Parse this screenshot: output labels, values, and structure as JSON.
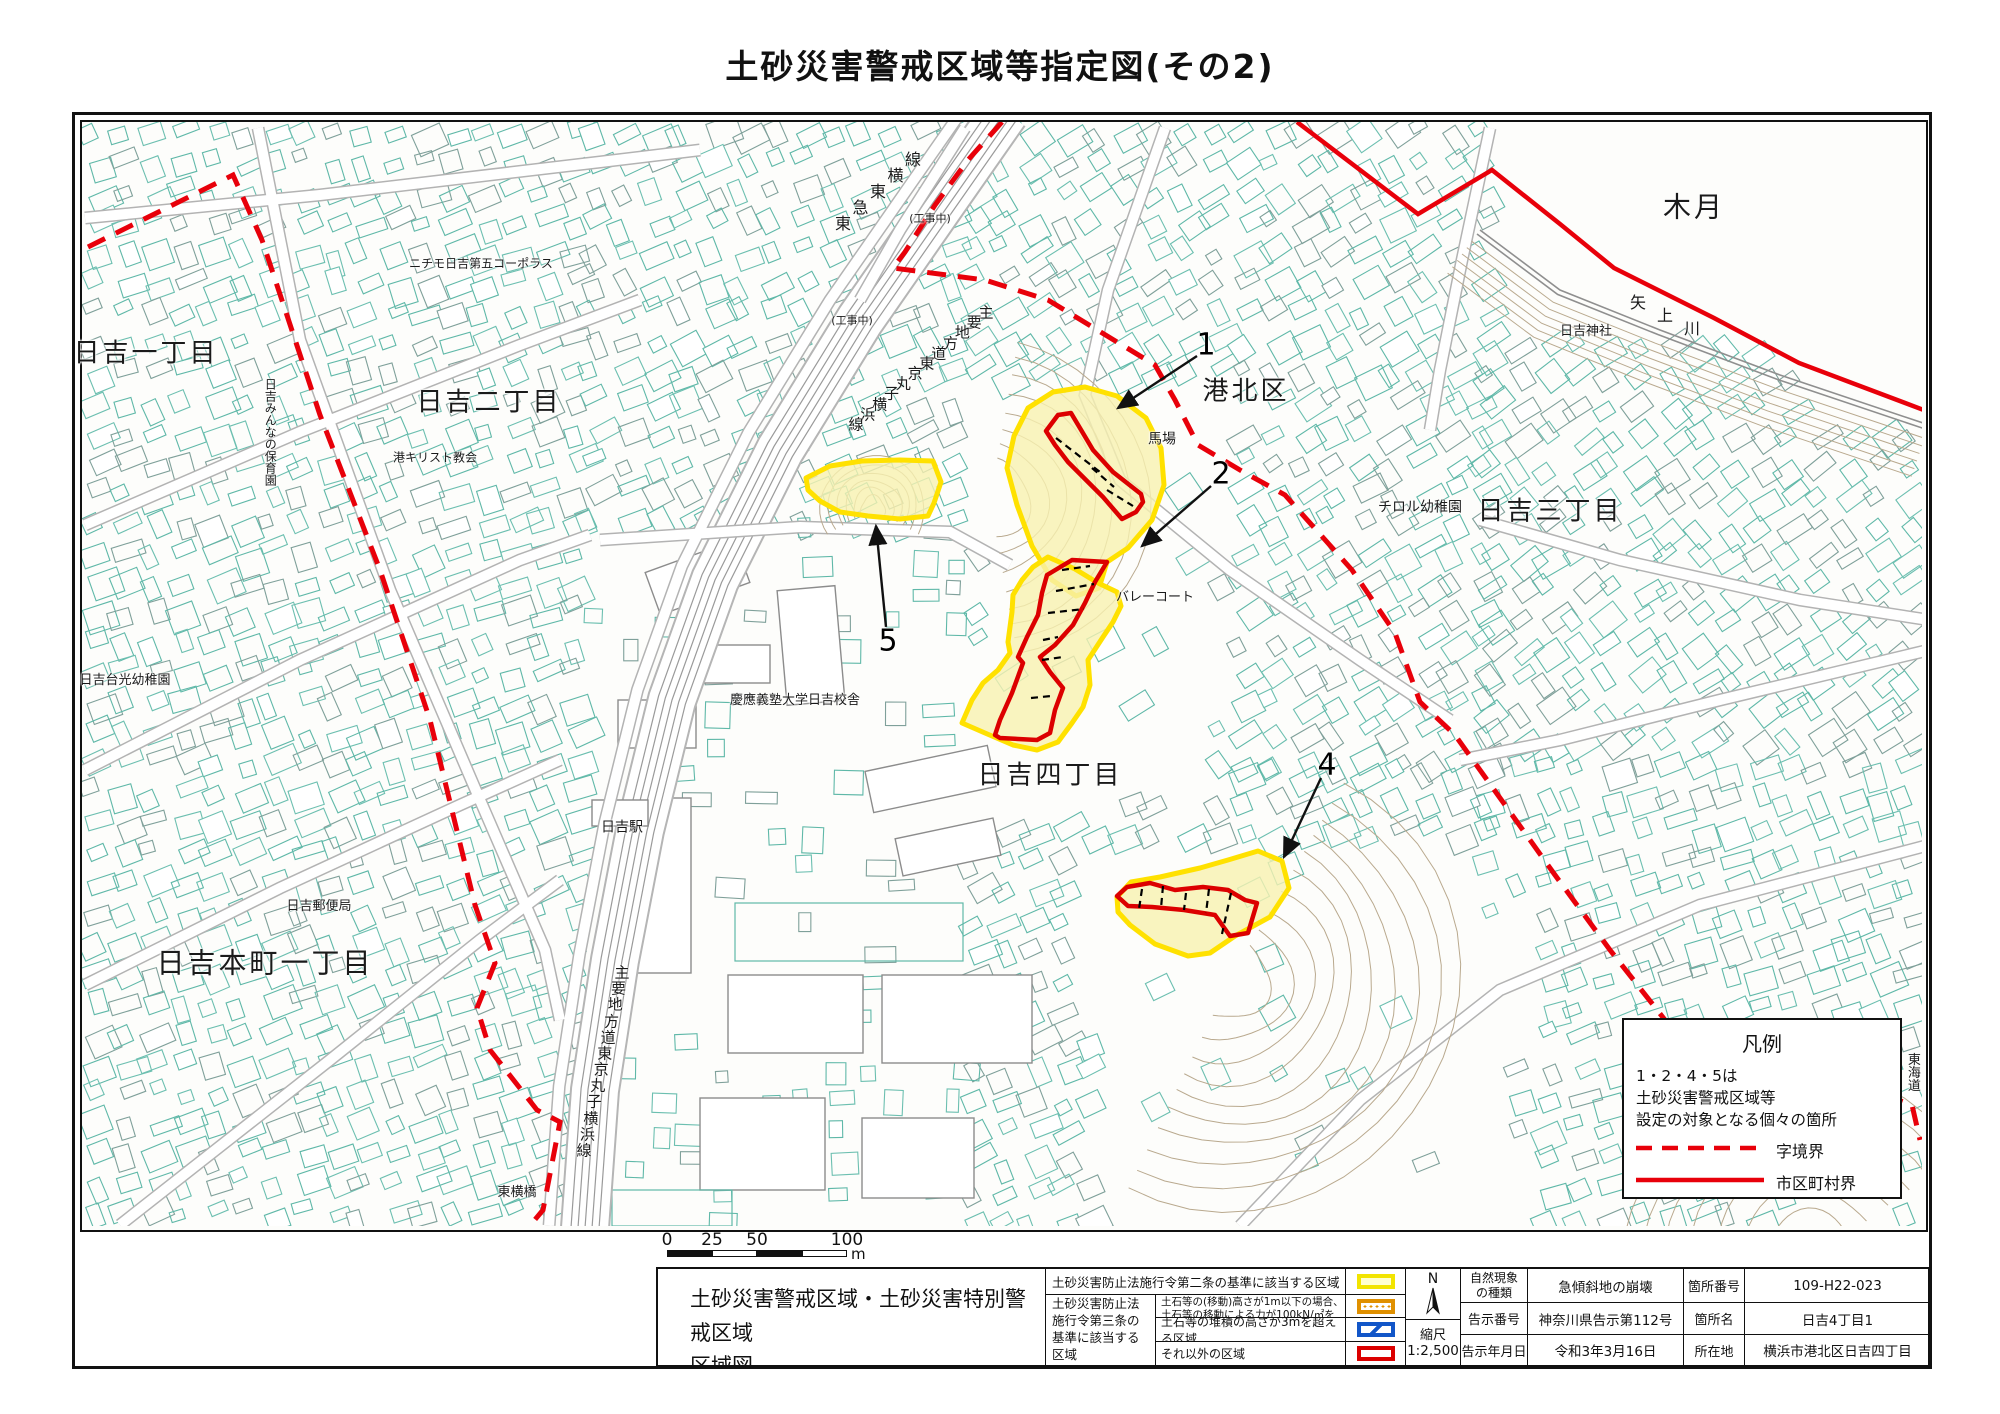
{
  "title": "土砂災害警戒区域等指定図(その2)",
  "map": {
    "labels": [
      {
        "t": "日吉一丁目",
        "x": 146,
        "y": 354,
        "s": 26
      },
      {
        "t": "日吉二丁目",
        "x": 489,
        "y": 403,
        "s": 26
      },
      {
        "t": "ニチモ日吉第五コーポラス",
        "x": 481,
        "y": 264,
        "s": 12
      },
      {
        "t": "日吉みんなの保育園",
        "x": 270,
        "y": 432,
        "s": 12,
        "v": 1
      },
      {
        "t": "港キリスト教会",
        "x": 435,
        "y": 458,
        "s": 12
      },
      {
        "t": "(工事中)",
        "x": 930,
        "y": 219,
        "s": 11
      },
      {
        "t": "(工事中)",
        "x": 852,
        "y": 321,
        "s": 11
      },
      {
        "t": "港北区",
        "x": 1246,
        "y": 392,
        "s": 26
      },
      {
        "t": "馬場",
        "x": 1162,
        "y": 440,
        "s": 14
      },
      {
        "t": "バレーコート",
        "x": 1155,
        "y": 598,
        "s": 13
      },
      {
        "t": "チロル幼稚園",
        "x": 1420,
        "y": 508,
        "s": 14
      },
      {
        "t": "日吉三丁目",
        "x": 1550,
        "y": 512,
        "s": 26
      },
      {
        "t": "日吉四丁目",
        "x": 1050,
        "y": 776,
        "s": 26
      },
      {
        "t": "慶應義塾大学日吉校舎",
        "x": 795,
        "y": 701,
        "s": 13
      },
      {
        "t": "日吉駅",
        "x": 622,
        "y": 828,
        "s": 14
      },
      {
        "t": "日吉台光幼稚園",
        "x": 125,
        "y": 681,
        "s": 13
      },
      {
        "t": "日吉郵便局",
        "x": 319,
        "y": 907,
        "s": 13
      },
      {
        "t": "日吉本町一丁目",
        "x": 265,
        "y": 963,
        "s": 28
      },
      {
        "t": "東横橋",
        "x": 517,
        "y": 1193,
        "s": 13
      },
      {
        "t": "木月",
        "x": 1694,
        "y": 207,
        "s": 28
      },
      {
        "t": "日吉神社",
        "x": 1586,
        "y": 332,
        "s": 13
      },
      {
        "t": "東海道",
        "x": 1912,
        "y": 1072,
        "s": 13,
        "v": 1
      }
    ],
    "path_labels": [
      {
        "t": "東急東横線",
        "x1": 843,
        "y1": 222,
        "x2": 913,
        "y2": 158,
        "s": 16
      },
      {
        "t": "主要地方道東京丸子横浜線",
        "x1": 986,
        "y1": 312,
        "x2": 856,
        "y2": 424,
        "s": 15
      },
      {
        "t": "主要地方道東京丸子横浜線",
        "x1": 622,
        "y1": 972,
        "x2": 584,
        "y2": 1150,
        "s": 15
      },
      {
        "t": "矢上川",
        "x1": 1638,
        "y1": 301,
        "x2": 1692,
        "y2": 327,
        "s": 16
      }
    ],
    "markers": [
      {
        "n": "1",
        "x": 1206,
        "y": 345,
        "ax": 1197,
        "ay": 356,
        "bx": 1118,
        "by": 408
      },
      {
        "n": "2",
        "x": 1221,
        "y": 474,
        "ax": 1211,
        "ay": 486,
        "bx": 1142,
        "by": 546
      },
      {
        "n": "4",
        "x": 1327,
        "y": 765,
        "ax": 1321,
        "ay": 778,
        "bx": 1284,
        "by": 857
      },
      {
        "n": "5",
        "x": 888,
        "y": 641,
        "ax": 886,
        "ay": 627,
        "bx": 876,
        "by": 526
      }
    ],
    "legend": {
      "title": "凡例",
      "line1": "1・2・4・5は",
      "line2": "土砂災害警戒区域等",
      "line3": "設定の対象となる個々の箇所",
      "dashed_label": "字境界",
      "solid_label": "市区町村界"
    }
  },
  "scalebar": {
    "t0": "0",
    "t1": "25",
    "t2": "50",
    "t3": "100",
    "unit": "m"
  },
  "titleblock": {
    "doc1": "土砂災害警戒区域・土砂災害特別警戒区域",
    "doc2": "区域図",
    "leg_row1": "土砂災害防止法施行令第二条の基準に該当する区域",
    "leg_group": "土砂災害防止法施行令第三条の基準に該当する区域",
    "leg_r2a": "土石等の(移動)高さが1m以下の場合、",
    "leg_r2b": "土石等の移動による力が100kN/㎡を超える区域",
    "leg_r3": "土石等の堆積の高さが3mを超える区域",
    "leg_r4": "それ以外の区域",
    "compass": "N",
    "scale_label": "縮尺",
    "scale_value": "1:2,500",
    "meta": {
      "r1l1": "自然現象の種類",
      "r1v1": "急傾斜地の崩壊",
      "r1l2": "箇所番号",
      "r1v2": "109-H22-023",
      "r2l1": "告示番号",
      "r2v1": "神奈川県告示第112号",
      "r2l2": "箇所名",
      "r2v2": "日吉4丁目1",
      "r3l1": "告示年月日",
      "r3v1": "令和3年3月16日",
      "r3l2": "所在地",
      "r3v2": "横浜市港北区日吉四丁目"
    }
  },
  "colors": {
    "boundary_red": "#e8000a",
    "zone_yellow": "#ffe100",
    "zone_fill": "#f7f1b0",
    "special_red": "#dc0000",
    "building_teal": "#5fb8a8"
  }
}
